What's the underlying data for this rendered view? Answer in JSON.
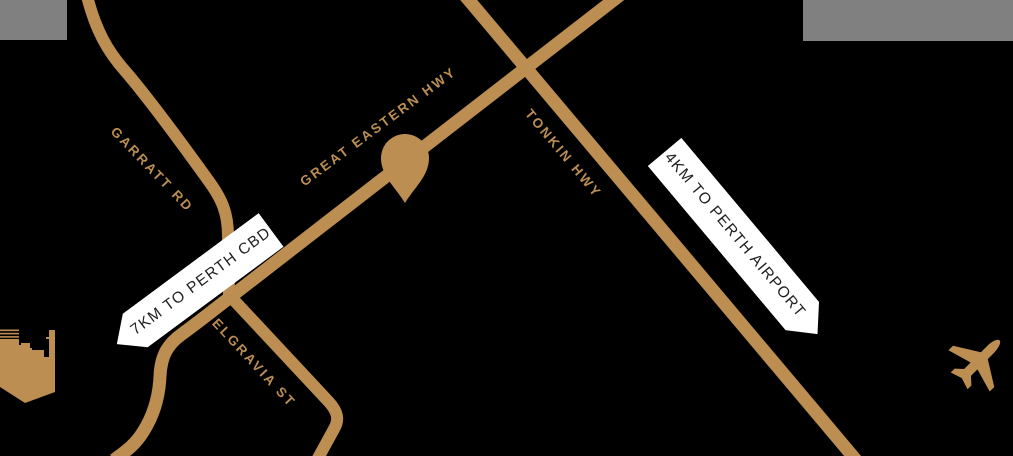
{
  "colors": {
    "background": "#000000",
    "road": "#BC8E52",
    "gray_block": "#808080",
    "banner_bg": "#FFFFFF",
    "banner_text": "#1F1F1F"
  },
  "roads": {
    "garratt": {
      "label": "GARRATT RD"
    },
    "great_eastern": {
      "label": "GREAT EASTERN HWY"
    },
    "tonkin": {
      "label": "TONKIN HWY"
    },
    "belgravia": {
      "label": "BELGRAVIA ST"
    }
  },
  "banners": {
    "cbd": {
      "label": "7KM TO PERTH CBD"
    },
    "airport": {
      "label": "4KM TO PERTH AIRPORT"
    }
  },
  "icons": {
    "pin": "location-pin",
    "city": "city-skyline",
    "plane": "airplane"
  }
}
